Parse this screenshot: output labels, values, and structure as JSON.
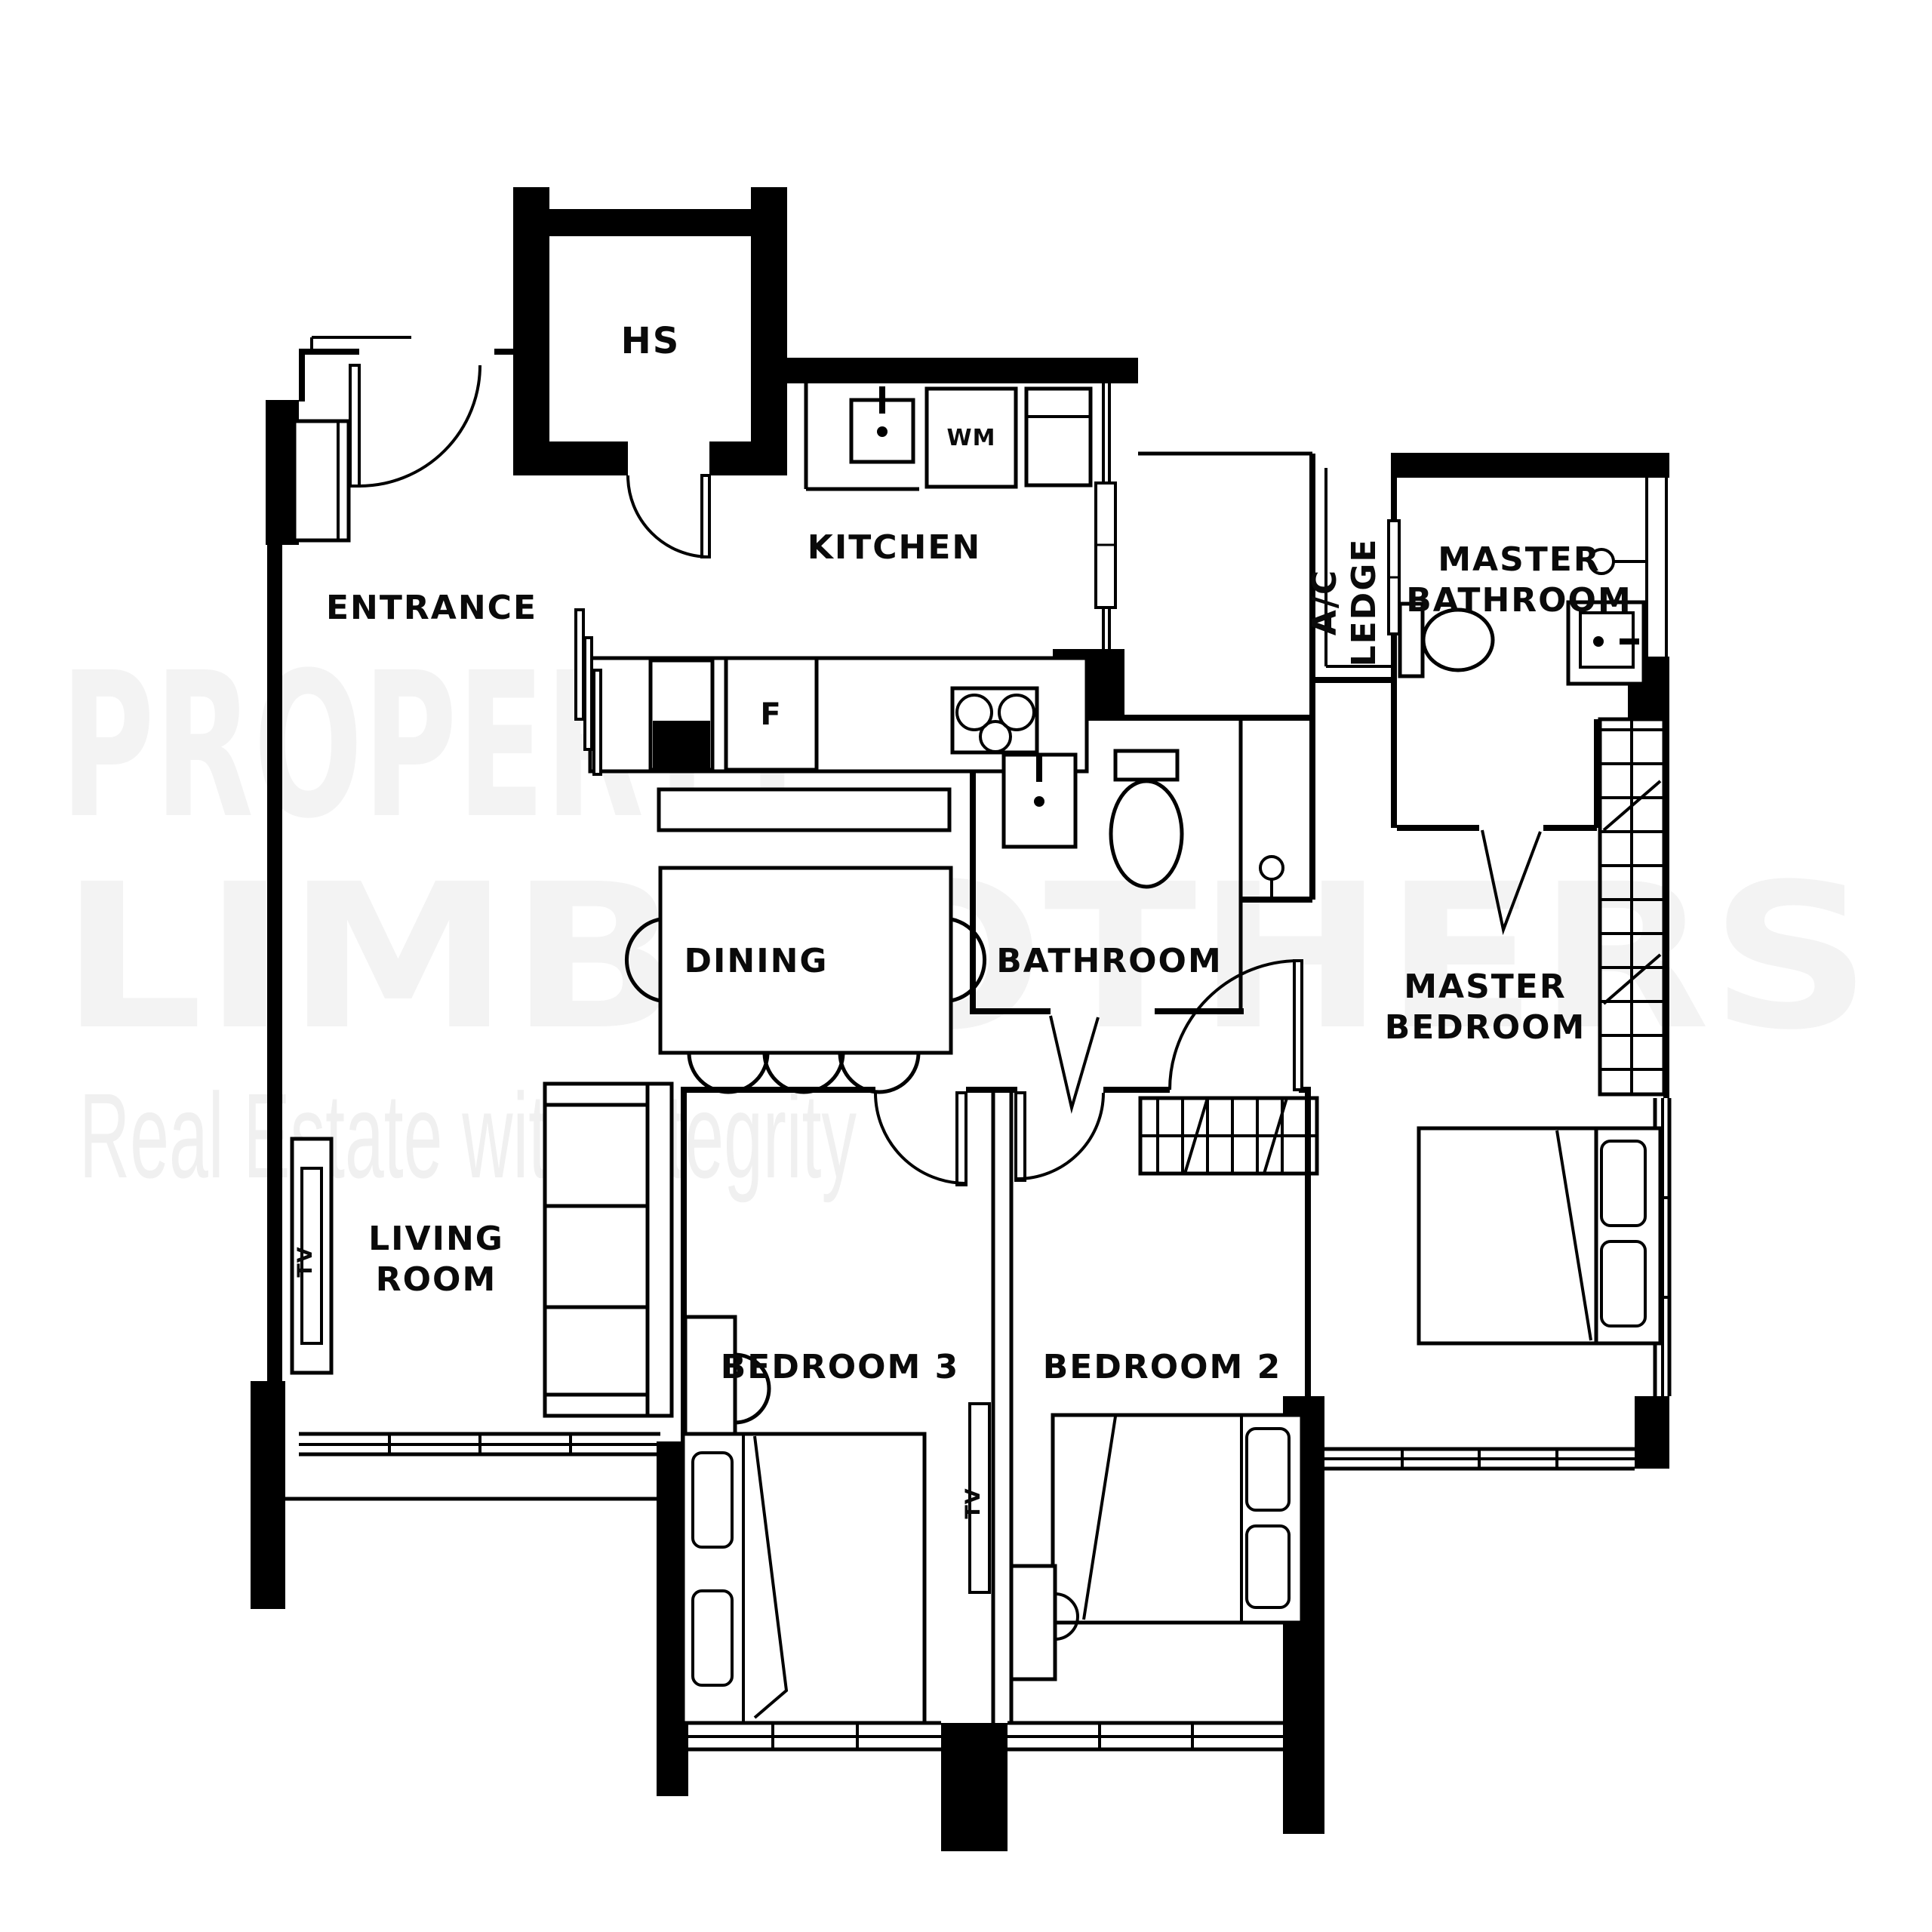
{
  "watermark": {
    "line1": "PROPERTY",
    "line2": "LIMBROTHERS",
    "tagline": "Real Estate with Integrity"
  },
  "rooms": {
    "hs": "HS",
    "kitchen": "KITCHEN",
    "entrance": "ENTRANCE",
    "ac_ledge_line1": "A/C",
    "ac_ledge_line2": "LEDGE",
    "master_bathroom_line1": "MASTER",
    "master_bathroom_line2": "BATHROOM",
    "dining": "DINING",
    "bathroom": "BATHROOM",
    "master_bedroom_line1": "MASTER",
    "master_bedroom_line2": "BEDROOM",
    "living_room_line1": "LIVING",
    "living_room_line2": "ROOM",
    "bedroom3": "BEDROOM 3",
    "bedroom2": "BEDROOM 2"
  },
  "fixtures": {
    "washing_machine": "WM",
    "fridge": "F",
    "tv_living": "TV",
    "tv_bedroom": "TV"
  },
  "colors": {
    "wall": "#000000",
    "background": "#ffffff",
    "watermark_primary": "#f3f3f3",
    "watermark_tagline": "#f0f0f0"
  }
}
